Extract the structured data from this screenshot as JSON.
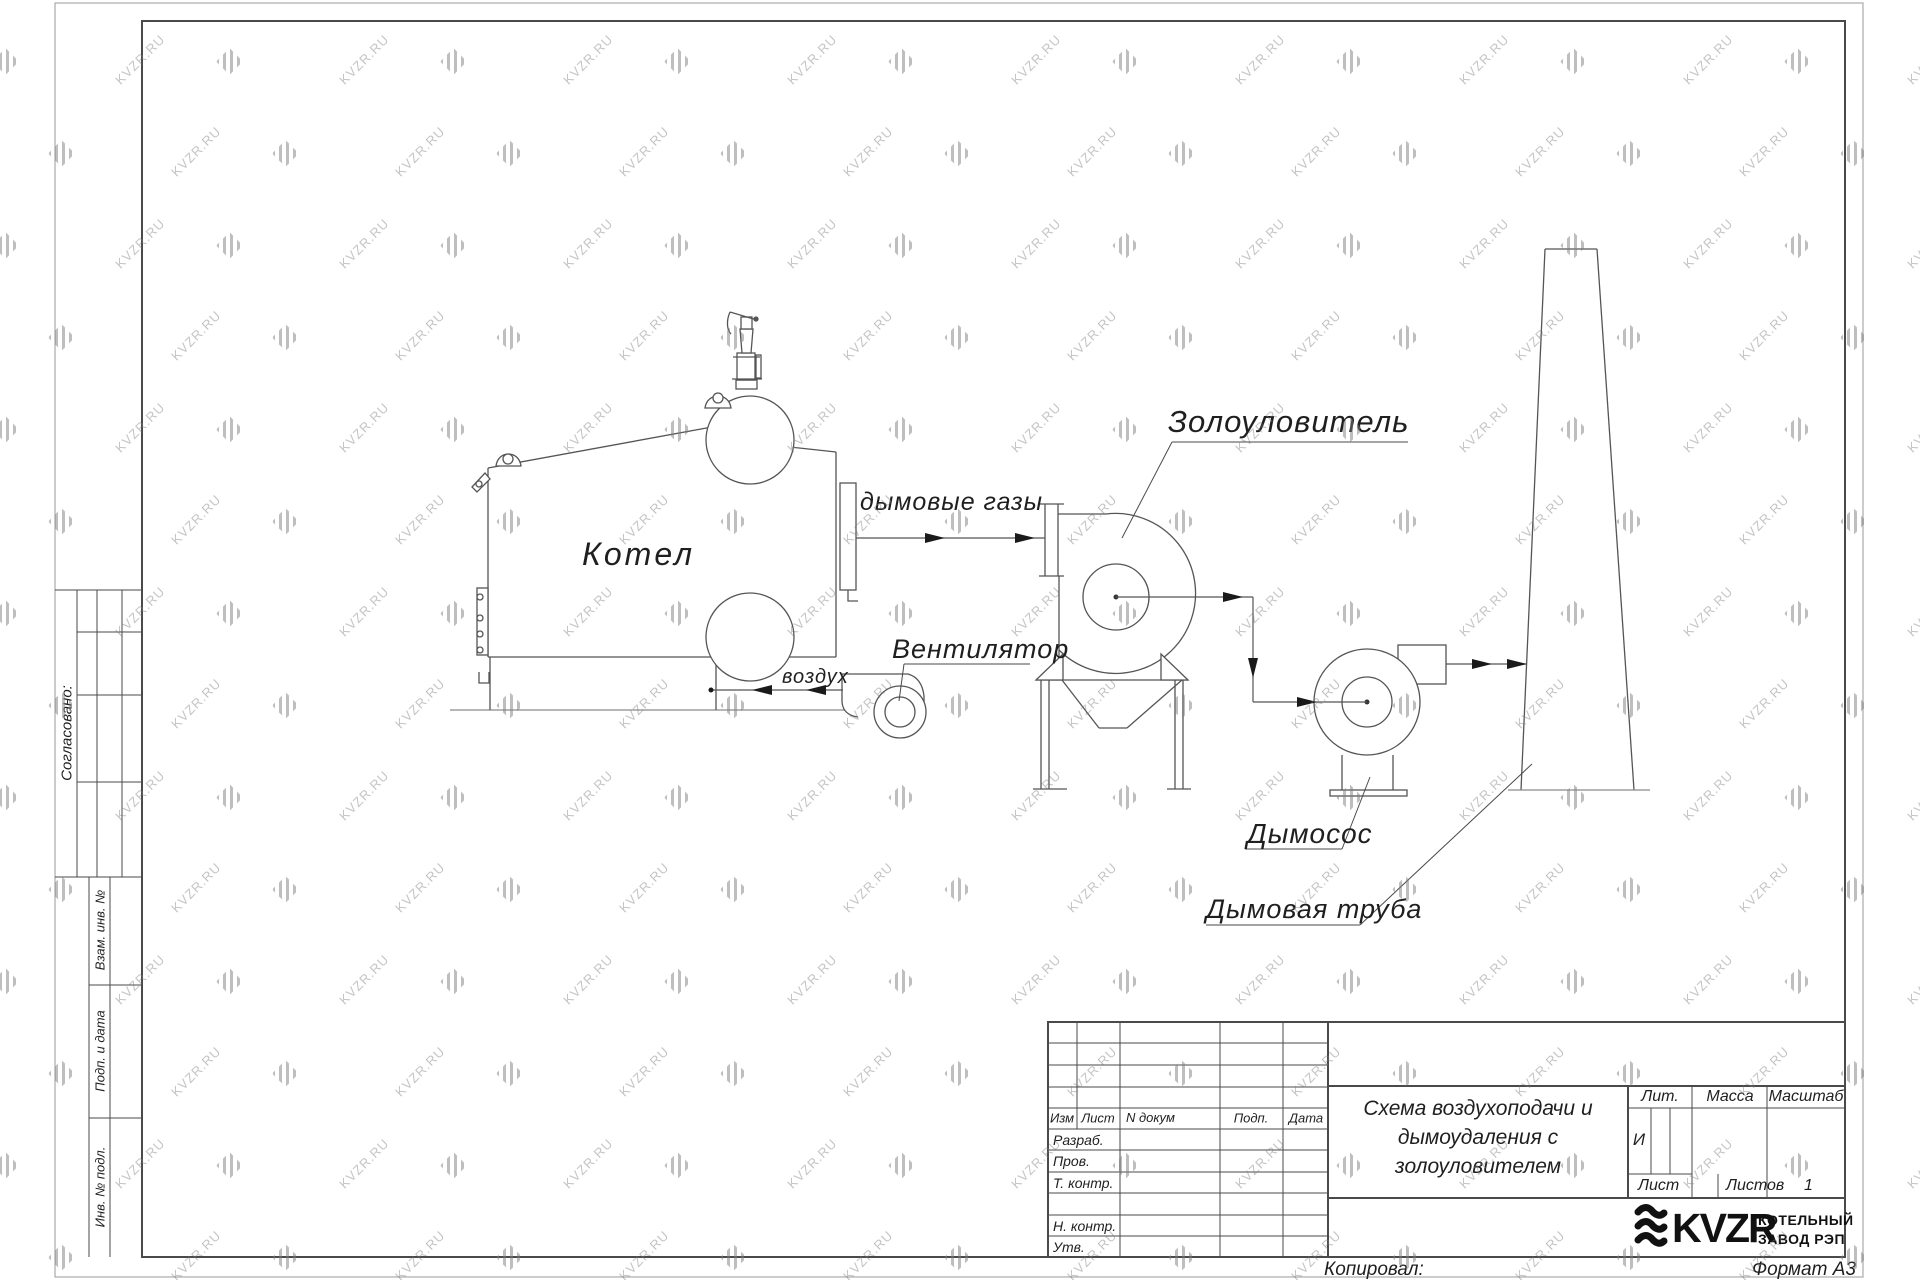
{
  "watermark": {
    "text": "KVZR.RU"
  },
  "colors": {
    "line": "#4a4a4a",
    "thin_line": "#8f8f8f",
    "logo": "#111111",
    "watermark": "#7d7d7d"
  },
  "margin_stamps": {
    "soglasovano": "Согласовано:",
    "vzam_inv": "Взам. инв. №",
    "podp_i_data": "Подп. и дата",
    "inv_podl": "Инв. № подл."
  },
  "diagram": {
    "labels": {
      "boiler": "Котел",
      "flue_gases": "дымовые газы",
      "fan": "Вентилятор",
      "air": "воздух",
      "ash_collector": "Золоуловитель",
      "smoke_exhauster": "Дымосос",
      "chimney": "Дымовая труба"
    }
  },
  "title_block": {
    "header": {
      "izm": "Изм",
      "list": "Лист",
      "n_dokum": "N докум",
      "podp": "Подп.",
      "data": "Дата"
    },
    "rows": {
      "razrab": "Разраб.",
      "prov": "Пров.",
      "t_kontr": "Т. контр.",
      "n_kontr": "Н. контр.",
      "utv": "Утв."
    },
    "title": "Схема воздухоподачи и\nдымоудаления с\nзолоуловителем",
    "lit_label": "Лит.",
    "lit_value": "И",
    "massa_label": "Масса",
    "masshtab_label": "Масштаб",
    "list_label": "Лист",
    "listov_label": "Листов",
    "listov_value": "1",
    "logo_text": "KVZR",
    "company_line1": "КОТЕЛЬНЫЙ",
    "company_line2": "ЗАВОД РЭП",
    "kopiroval": "Копировал:",
    "format": "Формат А3"
  }
}
